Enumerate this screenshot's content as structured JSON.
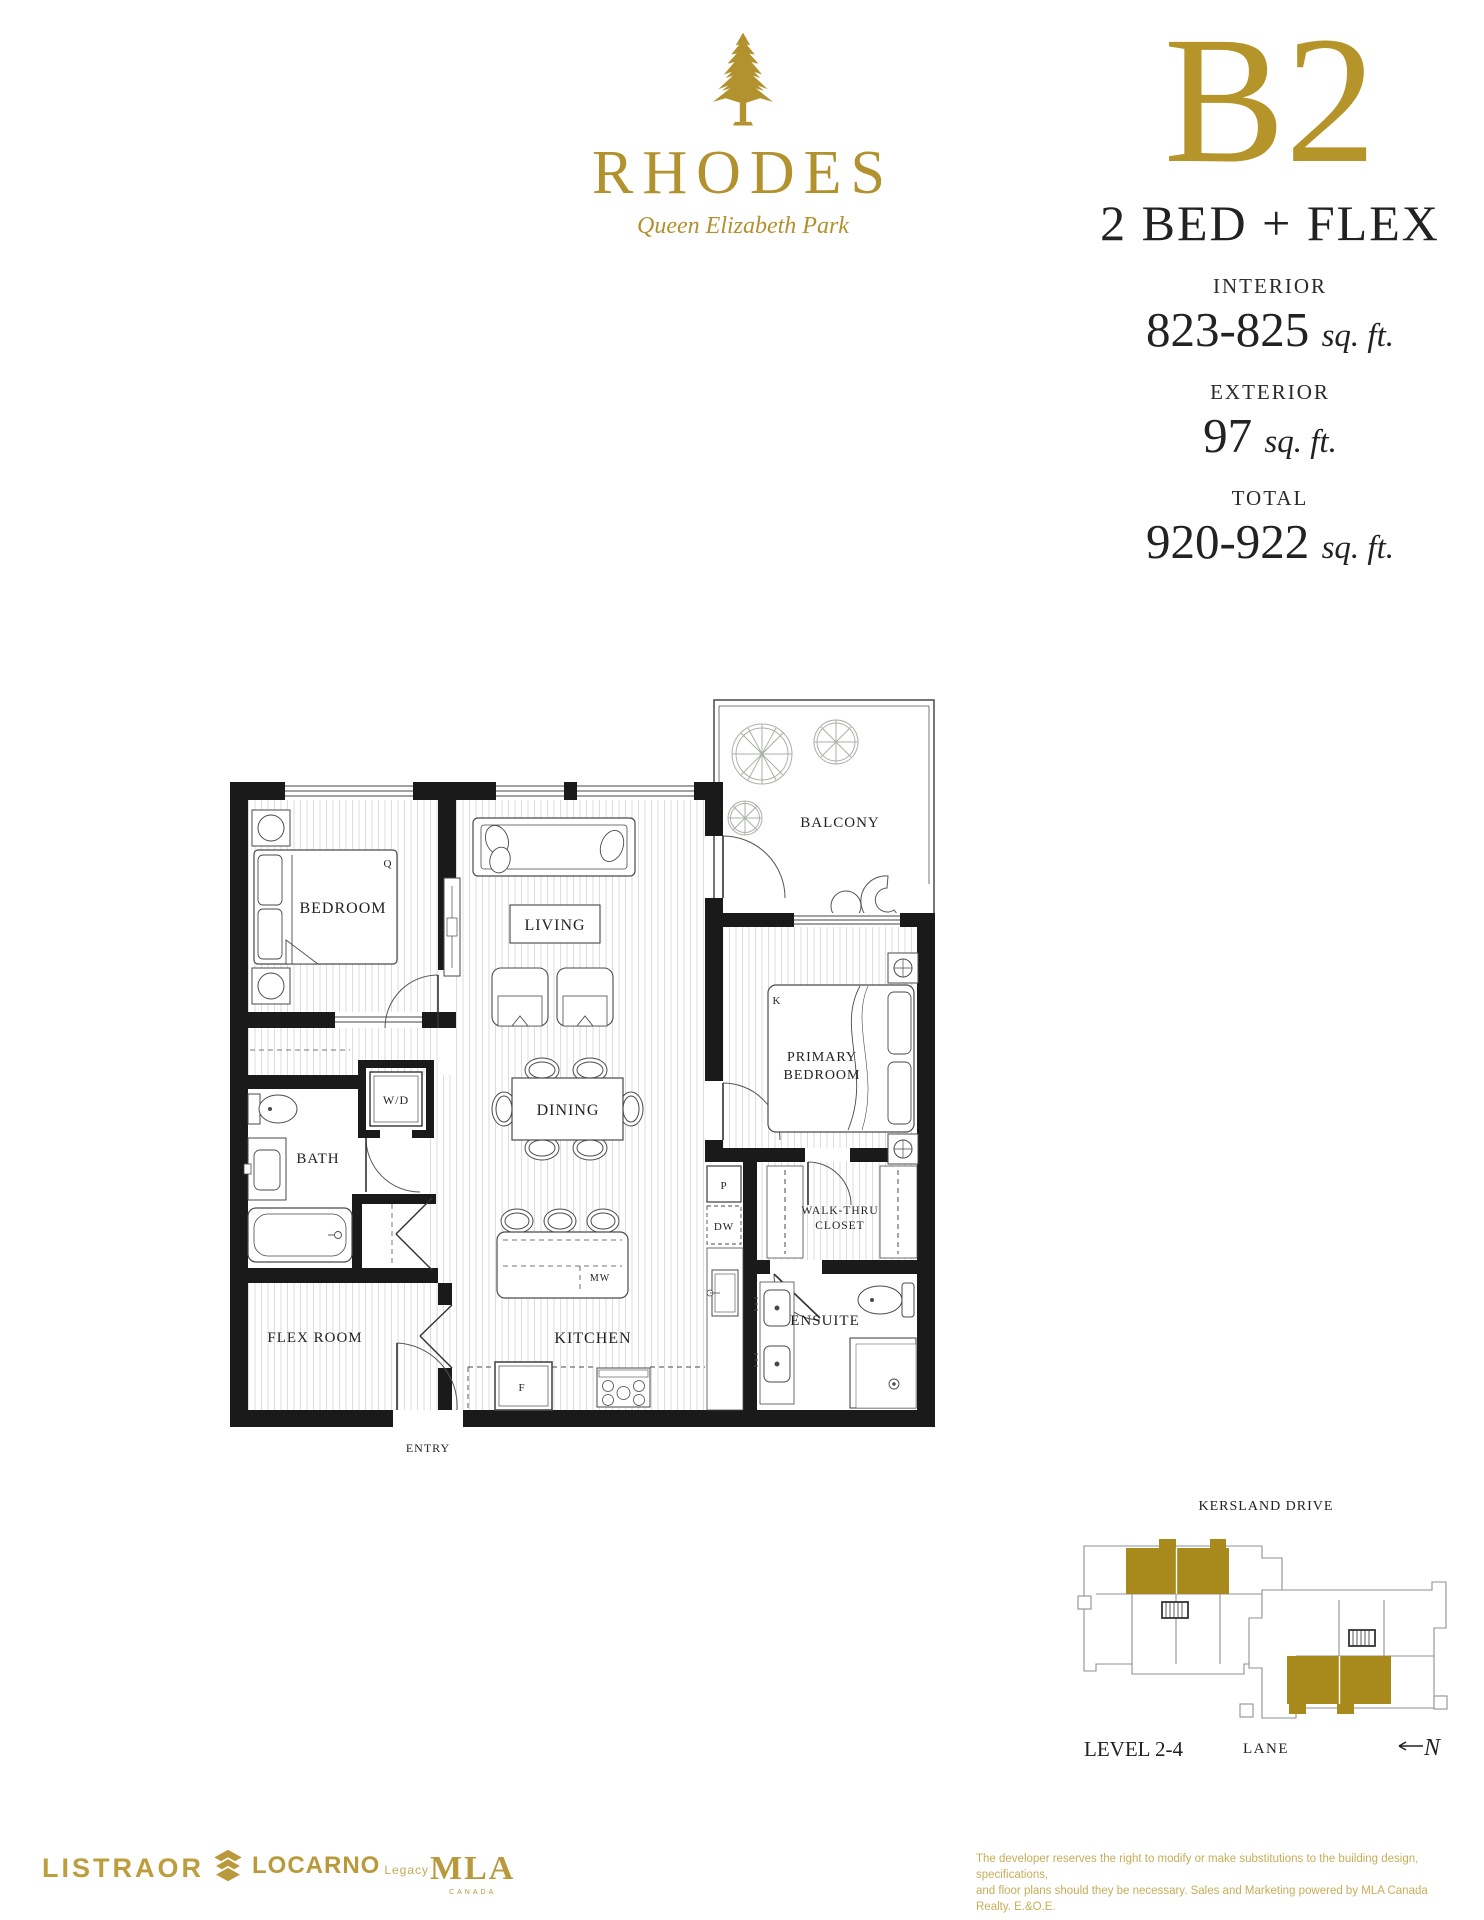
{
  "brand": {
    "name": "RHODES",
    "tagline": "Queen Elizabeth Park"
  },
  "plan": {
    "code": "B2",
    "type": "2 BED + FLEX",
    "stats": [
      {
        "label": "INTERIOR",
        "value": "823-825",
        "unit": "sq. ft."
      },
      {
        "label": "EXTERIOR",
        "value": "97",
        "unit": "sq. ft."
      },
      {
        "label": "TOTAL",
        "value": "920-922",
        "unit": "sq. ft."
      }
    ]
  },
  "fp": {
    "bedroom": "BEDROOM",
    "living": "LIVING",
    "dining": "DINING",
    "kitchen": "KITCHEN",
    "bath": "BATH",
    "flex_room": "FLEX ROOM",
    "balcony": "BALCONY",
    "primary_1": "PRIMARY",
    "primary_2": "BEDROOM",
    "closet_1": "WALK-THRU",
    "closet_2": "CLOSET",
    "ensuite": "ENSUITE",
    "entry": "ENTRY",
    "wd": "W/D",
    "q": "Q",
    "k": "K",
    "p": "P",
    "dw": "DW",
    "mw": "MW",
    "f": "F"
  },
  "site": {
    "street": "KERSLAND DRIVE",
    "level": "LEVEL 2-4",
    "lane": "LANE",
    "north": "N"
  },
  "footer": {
    "listraor": "LISTRAOR",
    "locarno": "LOCARNO",
    "locarno_suffix": "Legacy",
    "mla": "MLA",
    "mla_sub": "CANADA",
    "disclaimer_line1": "The developer reserves the right to modify or make substitutions to the building design, specifications,",
    "disclaimer_line2": "and floor plans should they be necessary. Sales and Marketing powered by MLA Canada Realty. E.&O.E."
  },
  "colors": {
    "gold": "#b2922e",
    "site_gold": "#a8891c",
    "footer_gold": "#bb9c42",
    "walls": "#1a1a1a"
  }
}
